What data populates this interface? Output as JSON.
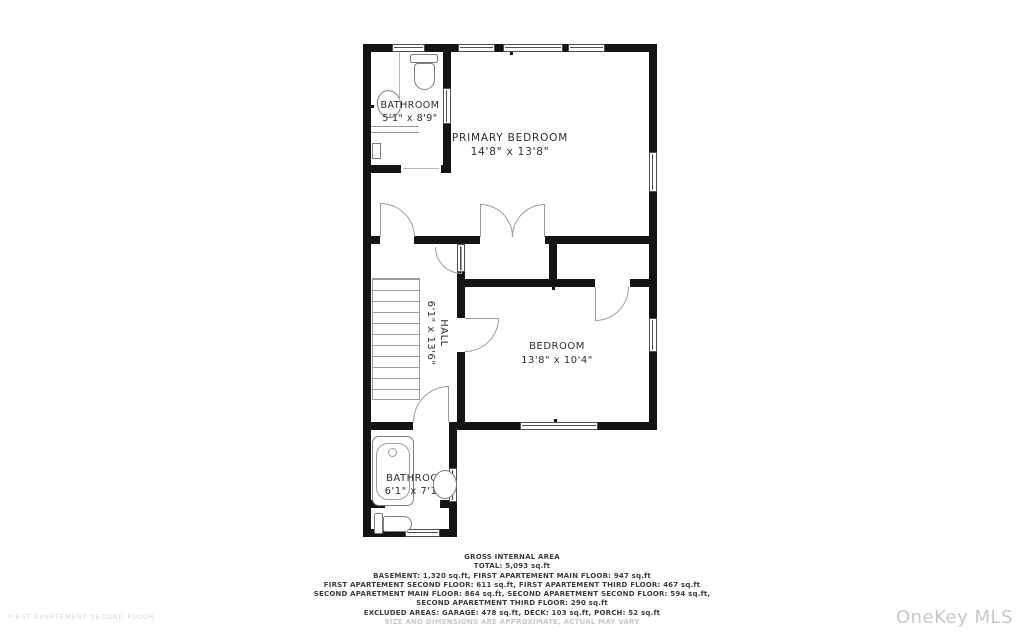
{
  "plan": {
    "rooms": [
      {
        "name": "BATHROOM",
        "dims": "5'1\" x 8'9\""
      },
      {
        "name": "PRIMARY BEDROOM",
        "dims": "14'8\" x 13'8\""
      },
      {
        "name": "HALL",
        "dims": "6'1\" x 13'6\""
      },
      {
        "name": "BEDROOM",
        "dims": "13'8\" x 10'4\""
      },
      {
        "name": "BATHROOM",
        "dims": "6'1\" x 7'10\""
      }
    ]
  },
  "footer": {
    "title": "GROSS INTERNAL AREA",
    "lines": [
      "TOTAL: 5,093 sq.ft",
      "BASEMENT: 1,320 sq.ft, FIRST APARTEMENT MAIN FLOOR: 947 sq.ft",
      "FIRST APARTEMENT SECOND FLOOR: 611 sq.ft, FIRST APARTEMENT THIRD FLOOR: 467 sq.ft",
      "SECOND APARETMENT MAIN FLOOR: 864 sq.ft, SECOND APARETMENT SECOND FLOOR: 594 sq.ft,",
      "SECOND APARETMENT THIRD FLOOR: 290 sq.ft",
      "EXCLUDED AREAS: GARAGE: 478 sq.ft, DECK: 103 sq.ft, PORCH: 52 sq.ft"
    ],
    "disclaimer": "SIZE AND DIMENSIONS ARE APPROXIMATE, ACTUAL MAY VARY"
  },
  "watermarks": {
    "left": "FIRST APARTEMENT SECOND FLOOR",
    "right": "OneKey MLS"
  },
  "colors": {
    "wall": "#141414",
    "fixture_line": "#7e7e7e",
    "door_arc": "#9b9b9b",
    "label_text": "#2e2e2e",
    "watermark": "#dcdcdc"
  }
}
